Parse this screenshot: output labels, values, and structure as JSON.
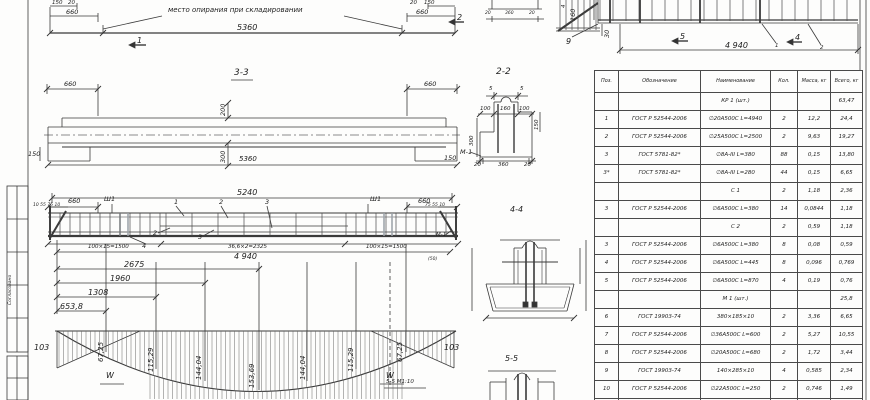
{
  "labels": {
    "storage_note": "место опирания при складировании",
    "d150l": "150",
    "d20l": "20",
    "d660tl": "660",
    "d5360t": "5360",
    "d20r": "20",
    "d150r": "150",
    "d660tr": "660",
    "sec1": "1",
    "sec2": "2",
    "sec4": "4",
    "sec5": "5",
    "pos9": "9",
    "tiny1": "1",
    "tiny2": "2",
    "ms20a": "20",
    "ms360": "360",
    "ms20b": "20",
    "d160": "160",
    "d30": "30",
    "d4rot": "4",
    "d4940tr": "4 940",
    "s33": "3-3",
    "s33_660l": "660",
    "s33_660r": "660",
    "s33_200": "200",
    "s33_300": "300",
    "s33_150": "150",
    "s33_5360": "5360",
    "s33_150r": "150",
    "s22": "2-2",
    "s22_5a": "5",
    "s22_5b": "5",
    "s22_100a": "100",
    "s22_160": "160",
    "s22_100b": "100",
    "s22_300": "300",
    "s22_150": "150",
    "s22_m1": "М-1",
    "s22_20a": "20",
    "s22_360": "360",
    "s22_20b": "20",
    "d5240": "5240",
    "c660l": "660",
    "c660r": "660",
    "sh1l": "Ш1",
    "sh1r": "Ш1",
    "tinyl": "10 55 75 10",
    "tinyr": "75 55 10",
    "b1": "1",
    "b2": "2",
    "b3": "3",
    "b2b": "2",
    "b3b": "3",
    "b4": "4",
    "m1cage": "М-1",
    "spl": "100×15=1500",
    "spm": "36,6×2=2325",
    "spr": "100×15=1500",
    "d4940": "4 940",
    "d50": "(50)",
    "ch2675": "2675",
    "ch1960": "1960",
    "ch1308": "1308",
    "ch653": "653,8",
    "s44": "4-4",
    "s55": "5-5",
    "s55note": "5-5 М1:10",
    "w1": "W",
    "w2": "W",
    "stamp": "Согласовано"
  },
  "moment": {
    "values": [
      "103",
      "67,25",
      "115,29",
      "144,04",
      "153,69",
      "144,04",
      "115,29",
      "67,25",
      "103"
    ]
  },
  "table": {
    "columns": [
      "Поз.",
      "Обозначение",
      "Наименование",
      "Кол.",
      "Масса, кг",
      "Всего, кг"
    ],
    "rows": [
      [
        "",
        "",
        "КР 1 (шт.)",
        "",
        "",
        "63,47"
      ],
      [
        "1",
        "ГОСТ Р 52544-2006",
        "∅20А500С  L=4940",
        "2",
        "12,2",
        "24,4"
      ],
      [
        "2",
        "ГОСТ Р 52544-2006",
        "∅25А500С  L=2500",
        "2",
        "9,63",
        "19,27"
      ],
      [
        "3",
        "ГОСТ 5781-82*",
        "∅8А-III  L=380",
        "88",
        "0,15",
        "13,80"
      ],
      [
        "3*",
        "ГОСТ 5781-82*",
        "∅8А-III  L=280",
        "44",
        "0,15",
        "6,65"
      ],
      [
        "",
        "",
        "С 1",
        "2",
        "1,18",
        "2,36"
      ],
      [
        "3",
        "ГОСТ Р 52544-2006",
        "∅6А500С  L=380",
        "14",
        "0,0844",
        "1,18"
      ],
      [
        "",
        "",
        "С 2",
        "2",
        "0,59",
        "1,18"
      ],
      [
        "3",
        "ГОСТ Р 52544-2006",
        "∅6А500С  L=380",
        "8",
        "0,08",
        "0,59"
      ],
      [
        "4",
        "ГОСТ Р 52544-2006",
        "∅6А500С  L=445",
        "8",
        "0,096",
        "0,769"
      ],
      [
        "5",
        "ГОСТ Р 52544-2006",
        "∅6А500С  L=870",
        "4",
        "0,19",
        "0,76"
      ],
      [
        "",
        "",
        "М 1 (шт.)",
        "",
        "",
        "25,8"
      ],
      [
        "6",
        "ГОСТ 19903-74",
        "380×185×10",
        "2",
        "3,36",
        "6,65"
      ],
      [
        "7",
        "ГОСТ Р 52544-2006",
        "∅36А500С  L=600",
        "2",
        "5,27",
        "10,55"
      ],
      [
        "8",
        "ГОСТ Р 52544-2006",
        "∅20А500С  L=680",
        "2",
        "1,72",
        "3,44"
      ],
      [
        "9",
        "ГОСТ 19903-74",
        "140×285×10",
        "4",
        "0,585",
        "2,34"
      ],
      [
        "10",
        "ГОСТ Р 52544-2006",
        "∅22А500С  L=250",
        "2",
        "0,746",
        "1,49"
      ],
      [
        "",
        "",
        "П 1",
        "2",
        "",
        "1,35"
      ]
    ]
  }
}
